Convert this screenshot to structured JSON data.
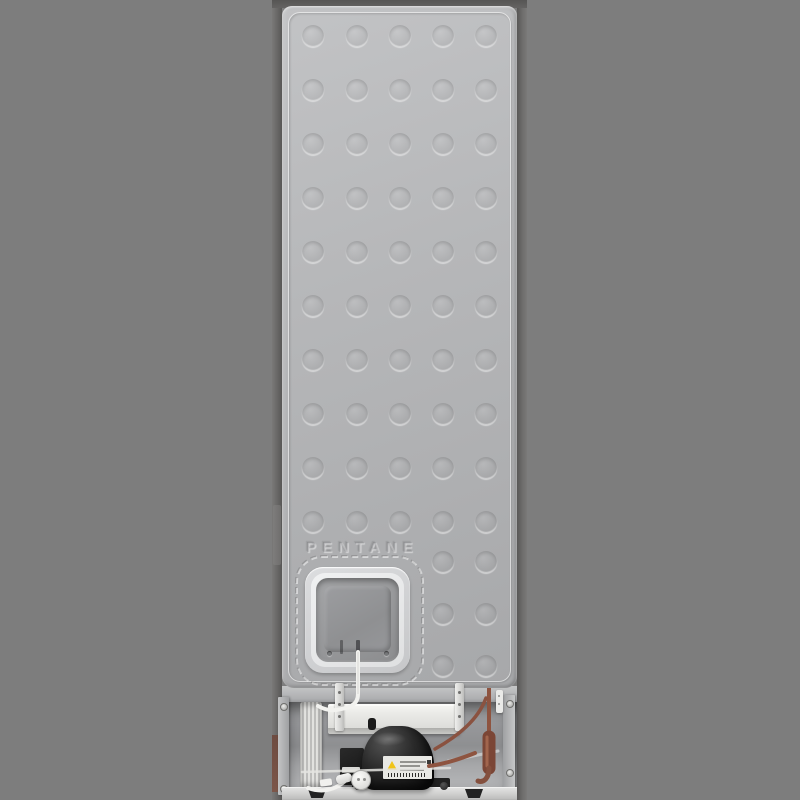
{
  "scene": {
    "type": "product-photo",
    "subject": "Rear view of a freestanding refrigerator showing embossed back panel and compressor bay",
    "background_color": "#7d7d7d"
  },
  "back_panel": {
    "embossed_text": "PENTANE",
    "panel_color": "#b4b5b7",
    "dimple_pattern": {
      "diameter": 22,
      "columns_x": [
        31,
        75,
        118,
        161,
        204
      ],
      "full_rows_y": [
        30,
        84,
        138,
        192,
        246,
        300,
        354,
        408,
        462,
        516
      ],
      "partial_rows_y": [
        556,
        608,
        660
      ],
      "partial_columns_x": [
        161,
        204
      ]
    },
    "access_cover": {
      "shape": "rounded-square",
      "screw_count": 2
    }
  },
  "machine_bay": {
    "components": [
      "evaporation-tray",
      "compressor",
      "compressor-rating-label",
      "relay-box",
      "power-cable-coil",
      "power-plug",
      "drier-filter",
      "copper-discharge-pipes",
      "mounting-straps",
      "base-rail"
    ],
    "colors": {
      "copper_pipe": "#8e5440",
      "drier_filter": "#7b4636",
      "compressor_body": "#1d1d1d",
      "tray_white": "#ececе9",
      "warning_triangle": "#f0c419",
      "cabinet_side": "#6b6a69",
      "bay_wall": "#96979a"
    }
  }
}
